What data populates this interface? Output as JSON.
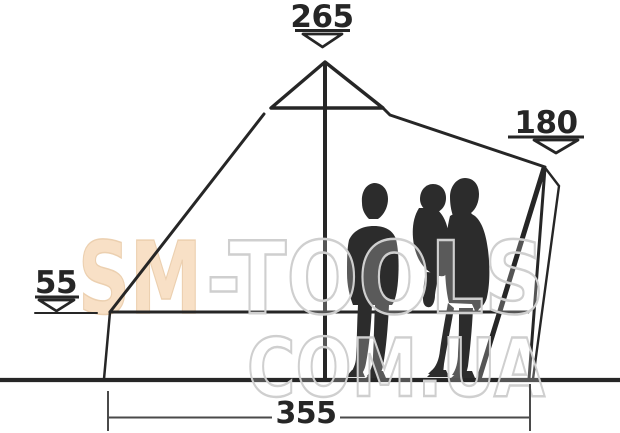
{
  "diagram": {
    "name": "tent-side-view-dimension-diagram",
    "dimensions": {
      "peak_height": "265",
      "door_height": "180",
      "wall_height": "55",
      "floor_width": "355"
    }
  },
  "watermark": {
    "brand_first": "SM",
    "brand_rest": "-TOOLS",
    "domain_line": "COM.UA"
  },
  "colors": {
    "line": "#262626",
    "dim": "#4a4a4a",
    "text": "#262626",
    "silhouette": "#2c2c2c",
    "watermark-peach": "#f8e0c6",
    "watermark-outline": "#cfcfcf",
    "background": "#ffffff"
  }
}
